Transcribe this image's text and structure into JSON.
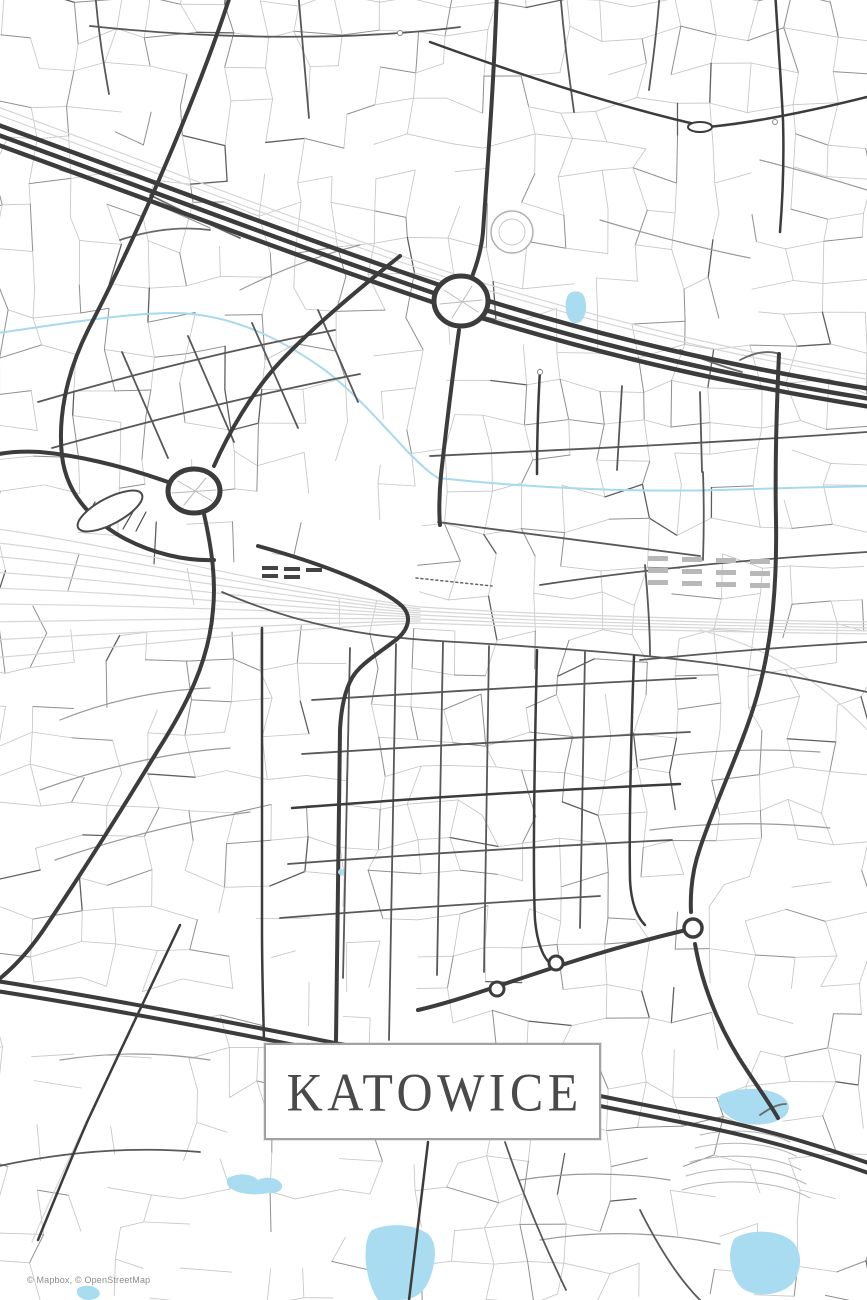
{
  "poster": {
    "title": "KATOWICE",
    "attribution": "© Mapbox, © OpenStreetMap"
  },
  "colors": {
    "background": "#ffffff",
    "road_major": "#3c3c3c",
    "road_medium": "#585858",
    "road_minor": "#c6c6c6",
    "railway": "#d6d6d6",
    "water": "#a9d9ee",
    "title_text": "#4a4a4a",
    "title_border": "#a2a2a2",
    "attribution_text": "#8c8c8c"
  },
  "map": {
    "viewbox": "0 0 867 1300",
    "texture": {
      "seed": 11,
      "cols": 25,
      "rows": 39,
      "jitter": 9,
      "skip": 0.3,
      "sparse_zones": [
        {
          "x": 0,
          "y": 990,
          "w": 175,
          "h": 140,
          "skip": 0.8
        },
        {
          "x": 240,
          "y": 930,
          "w": 190,
          "h": 110,
          "skip": 0.7
        },
        {
          "x": 0,
          "y": 505,
          "w": 420,
          "h": 135,
          "skip": 0.85
        },
        {
          "x": 560,
          "y": 1125,
          "w": 310,
          "h": 180,
          "skip": 0.55
        },
        {
          "x": 60,
          "y": 1140,
          "w": 400,
          "h": 160,
          "skip": 0.65
        },
        {
          "x": 590,
          "y": 180,
          "w": 180,
          "h": 140,
          "skip": 0.5
        },
        {
          "x": 230,
          "y": 90,
          "w": 140,
          "h": 110,
          "skip": 0.5
        },
        {
          "x": 420,
          "y": 330,
          "w": 120,
          "h": 120,
          "skip": 0.5
        }
      ]
    },
    "layers": [
      {
        "name": "railways",
        "type": "path",
        "stroke": "#d6d6d6",
        "width": 1.2,
        "items": [
          "M -10,528 C 120,545 260,585 420,607",
          "M -10,542 C 120,556 260,590 420,609",
          "M -10,556 C 120,567 260,595 420,611",
          "M -10,572 C 120,580 260,600 420,613",
          "M -10,588 C 120,592 260,605 420,615",
          "M -10,604 C 120,605 260,610 420,617",
          "M -10,622 C 120,620 260,617 420,619",
          "M -10,640 C 120,634 260,624 420,621",
          "M -10,658 C 130,647 260,630 420,623",
          "M 420,607 C 560,616 720,620 877,622",
          "M 420,611 C 560,619 720,623 877,625",
          "M 420,615 C 560,622 720,626 877,628",
          "M 420,619 C 560,625 720,629 877,631",
          "M 420,623 C 560,628 720,632 877,634",
          "M 700,630 C 780,650 830,690 877,740",
          "M -10,104 C 150,163 300,222 460,276 C 610,322 740,352 877,376",
          "M -10,112 C 150,170 300,229 460,282 C 610,328 740,357 877,381",
          "M 172,940 C 145,1000 110,1070 80,1135 C 65,1168 50,1200 32,1242"
        ]
      },
      {
        "name": "water-lines",
        "type": "path",
        "stroke": "#a9d9ee",
        "width": 2,
        "items": [
          "M -10,334 C 50,326 120,313 175,313 C 235,314 285,342 322,368 C 355,392 385,428 408,452 C 420,464 428,472 438,478 C 540,489 640,492 720,490 C 780,488 820,487 877,486"
        ]
      },
      {
        "name": "water-bodies",
        "type": "path",
        "stroke": "none",
        "width": 0,
        "fill": "#a9dcf0",
        "items": [
          "M 568,295 C 572,290 581,290 584,296 C 588,306 586,318 580,322 C 573,326 567,320 566,310 C 565,304 566,299 568,295 Z",
          "M 722,1094 C 740,1087 765,1087 780,1095 C 790,1101 792,1110 784,1117 C 770,1127 745,1127 731,1118 C 720,1111 714,1100 722,1094 Z",
          "M 228,1178 C 240,1172 252,1174 258,1180 C 266,1176 276,1177 281,1183 C 285,1189 278,1194 268,1193 C 255,1196 238,1194 230,1188 C 226,1184 226,1181 228,1178 Z",
          "M 372,1230 C 390,1222 415,1224 428,1234 C 438,1243 436,1262 430,1278 C 425,1292 415,1300 400,1300 L 378,1300 C 368,1285 364,1262 366,1246 C 367,1238 369,1233 372,1230 Z",
          "M 735,1238 C 752,1228 780,1230 793,1242 C 803,1252 802,1272 792,1284 C 780,1296 755,1298 742,1288 C 730,1278 726,1250 735,1238 Z",
          "M 78,1288 C 85,1284 95,1285 99,1291 C 102,1296 96,1300 88,1300 C 80,1300 74,1293 78,1288 Z"
        ]
      },
      {
        "name": "terraces",
        "type": "path",
        "stroke": "#b5b5b5",
        "width": 1,
        "items": [
          "M 700,1135 C 730,1128 765,1130 790,1142",
          "M 695,1148 C 728,1140 768,1142 796,1156",
          "M 690,1162 C 726,1152 772,1155 801,1170",
          "M 686,1176 C 724,1164 776,1168 806,1184",
          "M 682,1190 C 722,1176 780,1181 810,1198"
        ]
      },
      {
        "name": "minor-connectors",
        "type": "path",
        "stroke": "#9a9a9a",
        "width": 1.2,
        "items": [
          "M 60,720 C 110,700 160,690 210,688",
          "M 40,790 C 100,768 170,752 230,748",
          "M 55,860 C 120,838 190,820 250,812",
          "M 640,760 C 700,750 760,748 820,752",
          "M 650,830 C 710,822 770,822 830,828",
          "M 520,1180 C 570,1172 620,1172 670,1180",
          "M 540,1240 C 600,1230 660,1232 720,1244",
          "M 60,1060 C 110,1052 160,1052 210,1060",
          "M 240,290 C 280,270 320,255 360,245",
          "M 600,220 C 650,235 700,248 750,258",
          "M 760,160 C 800,170 835,180 867,190",
          "M 60,170 C 110,185 160,205 210,228"
        ]
      },
      {
        "name": "tunnel-dotted",
        "type": "path",
        "stroke": "#666666",
        "width": 1.5,
        "dash": "2,3",
        "items": [
          "M 416,578 L 492,586"
        ]
      },
      {
        "name": "ramps",
        "type": "path",
        "stroke": "#6a6a6a",
        "width": 1.8,
        "items": [
          "M 150,195 C 180,210 210,225 240,238",
          "M 120,240 C 150,230 180,226 210,230",
          "M 740,360 C 755,352 768,350 780,354",
          "M 760,1115 C 770,1108 778,1104 786,1104",
          "M 680,350 C 700,358 720,366 742,372"
        ]
      },
      {
        "name": "roads-medium",
        "type": "path",
        "stroke": "#585858",
        "width": 1.8,
        "items": [
          "M 350,648 L 343,978",
          "M 396,644 L 389,1040",
          "M 443,642 L 437,975",
          "M 489,646 L 484,972",
          "M 585,652 L 580,928",
          "M 312,700 C 440,692 570,684 696,678",
          "M 302,754 C 430,746 560,738 690,732",
          "M 288,864 C 420,854 550,846 672,840",
          "M 280,918 C 380,910 500,902 600,896",
          "M 38,402 C 140,372 240,348 335,330",
          "M 52,448 C 160,418 265,392 360,374",
          "M 122,352 L 168,458",
          "M 188,336 L 234,442",
          "M 252,323 L 298,428",
          "M 318,310 L 358,402",
          "M 430,456 C 560,450 700,444 867,432",
          "M 438,522 C 530,534 620,546 700,556",
          "M 540,585 C 640,570 740,560 867,552",
          "M 640,660 C 720,652 800,646 867,642",
          "M 622,386 L 617,470",
          "M 700,392 L 702,472",
          "M 703,472 C 704,500 704,530 703,560",
          "M 90,26 C 220,40 330,38 400,33 C 425,31 445,29 460,27",
          "M 95,-10 C 98,30 103,60 109,94",
          "M 298,-10 L 309,118",
          "M 560,-10 C 564,40 569,75 574,112",
          "M 660,-10 C 657,30 653,60 649,90",
          "M 505,1142 C 522,1192 542,1240 566,1290",
          "M -10,1168 C 60,1152 130,1146 200,1152",
          "M 640,1210 C 660,1250 680,1280 700,1300",
          "M 645,565 C 648,600 650,630 650,655",
          "M 222,592 C 300,626 370,637 440,641 C 540,647 620,652 700,662 C 760,669 820,682 867,692"
        ]
      },
      {
        "name": "roads-dark-medium",
        "type": "path",
        "stroke": "#3c3c3c",
        "width": 2.5,
        "items": [
          "M 428,1142 C 422,1196 415,1250 409,1300",
          "M 537,650 C 534,780 533,880 535,920 C 537,942 543,958 551,964",
          "M 634,656 C 631,740 629,820 630,880 C 631,900 636,916 645,925",
          "M 292,808 C 420,798 550,790 680,784",
          "M 540,370 C 538,405 537,440 537,474",
          "M 775,-10 C 778,40 781,80 783,120 C 784,155 783,195 780,232",
          "M 430,42 C 540,82 630,110 708,127",
          "M 708,127 C 760,122 815,110 867,97",
          "M 180,925 C 152,985 118,1055 88,1120 C 72,1156 56,1196 38,1240",
          "M 262,628 C 262,720 262,820 262,930 C 262,970 263,1005 264,1040"
        ]
      },
      {
        "name": "roads-dark-major",
        "type": "path",
        "stroke": "#3c3c3c",
        "width": 4,
        "items": [
          "M 232,-10 C 200,90 140,230 88,330 C 65,376 58,420 62,456 C 66,490 86,516 120,536 C 152,554 186,561 214,560",
          "M 497,-10 C 494,80 488,160 483,232 C 481,255 472,280 463,296",
          "M 459,330 C 452,380 446,430 441,475 C 439,495 439,515 440,525",
          "M 400,256 C 360,288 315,325 280,362 C 252,392 228,434 214,466",
          "M 168,482 C 120,465 75,455 40,452 C 22,451 5,452 -10,456",
          "M 204,514 C 212,550 216,580 213,610 C 209,662 186,706 158,750 C 124,806 80,876 42,932 C 28,952 10,972 -10,986",
          "M 258,546 C 330,566 382,588 402,606 C 412,616 409,629 397,639 C 378,654 360,664 352,678 C 344,692 341,710 340,730 L 336,1040",
          "M 779,354 C 776,420 775,470 776,520 C 777,580 773,640 757,696 C 743,745 716,800 700,848 C 693,868 690,890 691,912",
          "M 695,944 C 703,990 722,1034 748,1072 C 760,1090 770,1104 778,1118",
          "M 418,1010 C 480,996 560,960 686,930"
        ]
      },
      {
        "name": "highway-top",
        "type": "path",
        "stroke": "#3c3c3c",
        "width": 4.5,
        "items": [
          "M -10,122 C 150,180 300,238 460,292 C 610,340 740,368 877,390",
          "M -10,132 C 150,190 300,248 460,302 C 610,350 740,378 877,400",
          "M -10,142 C 150,200 300,258 462,312 C 610,358 740,386 877,408"
        ]
      },
      {
        "name": "highway-bottom",
        "type": "path",
        "stroke": "#3c3c3c",
        "width": 4,
        "items": [
          "M -10,980 C 120,1000 260,1028 400,1056 C 520,1080 620,1100 700,1116 C 770,1130 820,1146 877,1166",
          "M -10,990 C 120,1010 260,1038 400,1066 C 520,1090 620,1110 700,1126 C 770,1140 820,1156 877,1176"
        ]
      },
      {
        "name": "stadium-hatch",
        "type": "path",
        "stroke": "#4a4a4a",
        "width": 1.2,
        "items": [
          "M 85,520 L 95,502",
          "M 97,524 L 108,505",
          "M 110,527 L 121,508",
          "M 123,529 L 134,510",
          "M 136,531 L 146,512"
        ]
      },
      {
        "name": "circles",
        "type": "circle",
        "items": [
          {
            "cx": 512,
            "cy": 232,
            "r": 21,
            "stroke": "#b0b0b0",
            "width": 1.5,
            "fill": "#ffffff"
          },
          {
            "cx": 512,
            "cy": 232,
            "r": 13,
            "stroke": "#c8c8c8",
            "width": 1,
            "fill": "none"
          },
          {
            "cx": 110,
            "cy": 511,
            "rx": 36,
            "ry": 13,
            "rot": -28,
            "stroke": "#4a4a4a",
            "width": 2,
            "fill": "#ffffff"
          },
          {
            "cx": 461,
            "cy": 301,
            "rx": 27,
            "ry": 25,
            "stroke": "#3c3c3c",
            "width": 5,
            "fill": "#ffffff"
          },
          {
            "cx": 194,
            "cy": 491,
            "rx": 26,
            "ry": 22,
            "stroke": "#3c3c3c",
            "width": 5,
            "fill": "#ffffff"
          },
          {
            "cx": 693,
            "cy": 928,
            "r": 9,
            "stroke": "#3c3c3c",
            "width": 3.5,
            "fill": "#ffffff"
          },
          {
            "cx": 497,
            "cy": 989,
            "r": 7,
            "stroke": "#3c3c3c",
            "width": 3,
            "fill": "#ffffff"
          },
          {
            "cx": 556,
            "cy": 963,
            "r": 7,
            "stroke": "#3c3c3c",
            "width": 3,
            "fill": "#ffffff"
          },
          {
            "cx": 700,
            "cy": 127,
            "rx": 12,
            "ry": 5,
            "stroke": "#3c3c3c",
            "width": 2,
            "fill": "#ffffff"
          },
          {
            "cx": 400,
            "cy": 33,
            "r": 2.5,
            "stroke": "#888888",
            "width": 1,
            "fill": "#ffffff"
          },
          {
            "cx": 540,
            "cy": 372,
            "r": 2.5,
            "stroke": "#888888",
            "width": 1,
            "fill": "#ffffff"
          },
          {
            "cx": 775,
            "cy": 122,
            "r": 2.5,
            "stroke": "#888888",
            "width": 1,
            "fill": "#ffffff"
          },
          {
            "cx": 341,
            "cy": 872,
            "r": 3,
            "stroke": "none",
            "width": 0,
            "fill": "#a9dcf0"
          }
        ]
      },
      {
        "name": "roundabout-spokes",
        "type": "path",
        "stroke": "#bbbbbb",
        "width": 1,
        "items": [
          "M 444,290 L 478,312",
          "M 452,318 L 472,286",
          "M 440,304 L 482,300",
          "M 178,481 L 212,501",
          "M 184,505 L 206,478",
          "M 172,493 L 216,490"
        ]
      },
      {
        "name": "platforms",
        "type": "rect",
        "items": [
          {
            "x": 262,
            "y": 566,
            "w": 16,
            "h": 4,
            "fill": "#444444"
          },
          {
            "x": 262,
            "y": 574,
            "w": 16,
            "h": 4,
            "fill": "#444444"
          },
          {
            "x": 284,
            "y": 567,
            "w": 16,
            "h": 4,
            "fill": "#444444"
          },
          {
            "x": 284,
            "y": 575,
            "w": 16,
            "h": 4,
            "fill": "#444444"
          },
          {
            "x": 306,
            "y": 568,
            "w": 16,
            "h": 4,
            "fill": "#444444"
          },
          {
            "x": 648,
            "y": 556,
            "w": 20,
            "h": 5,
            "fill": "#b8b8b8"
          },
          {
            "x": 648,
            "y": 568,
            "w": 20,
            "h": 5,
            "fill": "#b8b8b8"
          },
          {
            "x": 648,
            "y": 580,
            "w": 20,
            "h": 5,
            "fill": "#b8b8b8"
          },
          {
            "x": 682,
            "y": 557,
            "w": 20,
            "h": 5,
            "fill": "#b8b8b8"
          },
          {
            "x": 682,
            "y": 569,
            "w": 20,
            "h": 5,
            "fill": "#b8b8b8"
          },
          {
            "x": 682,
            "y": 581,
            "w": 20,
            "h": 5,
            "fill": "#b8b8b8"
          },
          {
            "x": 716,
            "y": 558,
            "w": 20,
            "h": 5,
            "fill": "#b8b8b8"
          },
          {
            "x": 716,
            "y": 570,
            "w": 20,
            "h": 5,
            "fill": "#b8b8b8"
          },
          {
            "x": 716,
            "y": 582,
            "w": 20,
            "h": 5,
            "fill": "#b8b8b8"
          },
          {
            "x": 750,
            "y": 559,
            "w": 20,
            "h": 5,
            "fill": "#b8b8b8"
          },
          {
            "x": 750,
            "y": 571,
            "w": 20,
            "h": 5,
            "fill": "#b8b8b8"
          },
          {
            "x": 750,
            "y": 583,
            "w": 20,
            "h": 5,
            "fill": "#b8b8b8"
          }
        ]
      }
    ]
  }
}
